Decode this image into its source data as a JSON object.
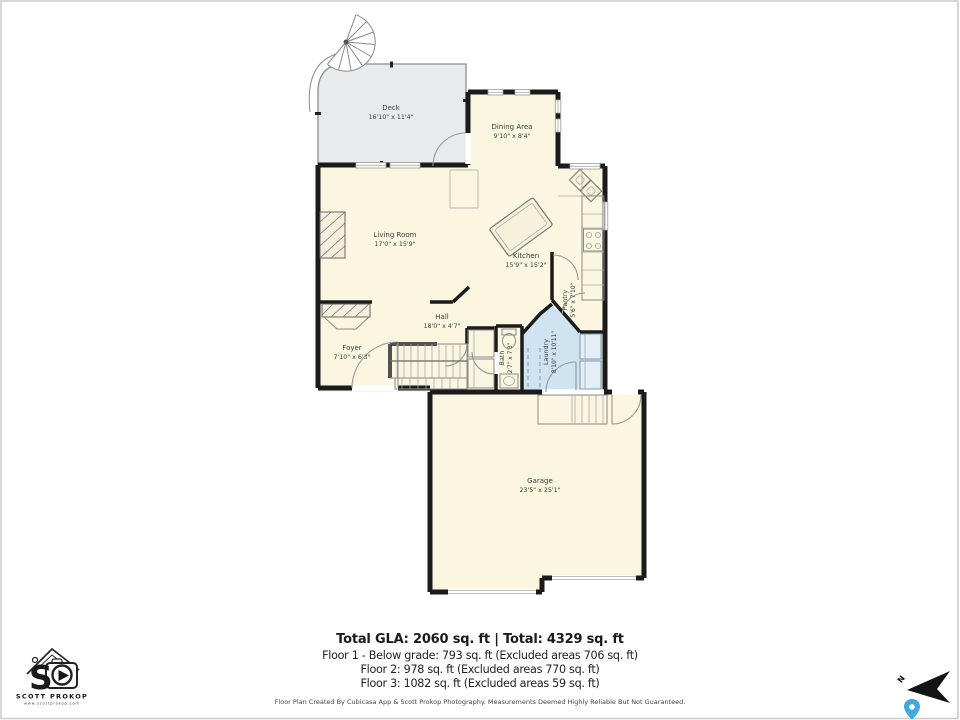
{
  "rooms": [
    {
      "name": "Deck",
      "dims": "16'10\" x 11'4\""
    },
    {
      "name": "Dining Area",
      "dims": "9'10\" x 8'4\""
    },
    {
      "name": "Living Room",
      "dims": "17'0\" x 15'9\""
    },
    {
      "name": "Kitchen",
      "dims": "15'9\" x 15'2\""
    },
    {
      "name": "Pantry",
      "dims": "5'6\" x 7'10\""
    },
    {
      "name": "Hall",
      "dims": "18'0\" x 4'7\""
    },
    {
      "name": "Foyer",
      "dims": "7'10\" x 6'3\""
    },
    {
      "name": "Bath",
      "dims": "2'7\" x 7'3\""
    },
    {
      "name": "Laundry",
      "dims": "8'10\" x 10'11\""
    },
    {
      "name": "Garage",
      "dims": "23'5\" x 25'1\""
    }
  ],
  "summary": {
    "total_line": "Total GLA: 2060 sq. ft | Total: 4329 sq. ft",
    "floors": [
      "Floor 1 - Below grade: 793 sq. ft (Excluded areas 706 sq. ft)",
      "Floor 2: 978 sq. ft (Excluded areas 770 sq. ft)",
      "Floor 3: 1082 sq. ft (Excluded areas 59 sq. ft)"
    ],
    "disclaimer": "Floor Plan Created By Cubicasa App & Scott Prokop Photography. Measurements Deemed Highly Reliable But Not Guaranteed."
  },
  "logo": {
    "brand": "SCOTT PROKOP",
    "website": "www.scottprokop.com",
    "monogram": "S"
  },
  "compass": {
    "north_label": "N"
  },
  "colors": {
    "room_fill": "#faf6e0",
    "deck_fill": "#e9eaec",
    "laundry_fill": "#cfe3f1",
    "wall": "#1b1b1b",
    "pin": "#3fa9e0"
  }
}
